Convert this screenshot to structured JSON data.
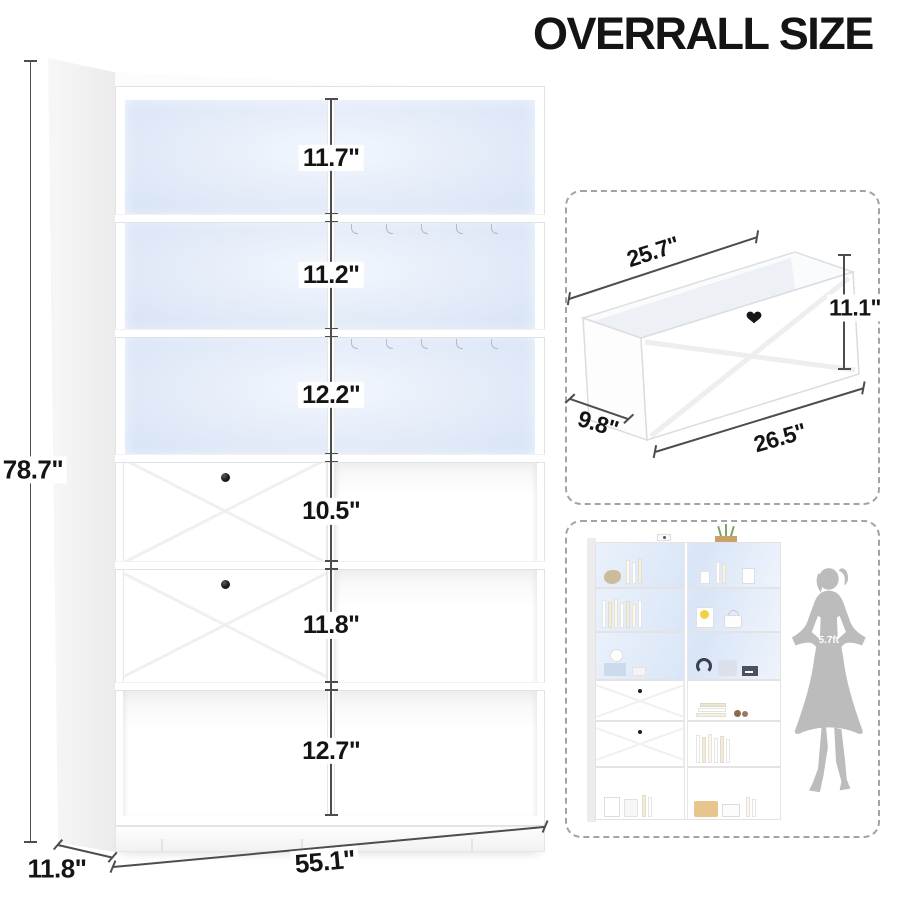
{
  "title": "OVERRALL SIZE",
  "main_diagram": {
    "overall_height_label": "78.7\"",
    "overall_depth_label": "11.8\"",
    "overall_width_label": "55.1\"",
    "shelf_sections": [
      {
        "label": "11.7\"",
        "inches": 11.7
      },
      {
        "label": "11.2\"",
        "inches": 11.2
      },
      {
        "label": "12.2\"",
        "inches": 12.2
      },
      {
        "label": "10.5\"",
        "inches": 10.5
      },
      {
        "label": "11.8\"",
        "inches": 11.8
      },
      {
        "label": "12.7\"",
        "inches": 12.7
      }
    ]
  },
  "drawer_inset": {
    "back_width_label": "25.7\"",
    "height_label": "11.1\"",
    "depth_label": "9.8\"",
    "front_width_label": "26.5\""
  },
  "scale_inset": {
    "person_height_label": "5.7ft"
  },
  "colors": {
    "text_dark": "#141414",
    "dim_line": "#4d4d4d",
    "led_glow": "#dde7f7",
    "dash_border": "#a3a3a3",
    "silhouette_gray": "#bcbcbc",
    "knob_black": "#17181c",
    "accent_tan": "#e7c58d"
  }
}
